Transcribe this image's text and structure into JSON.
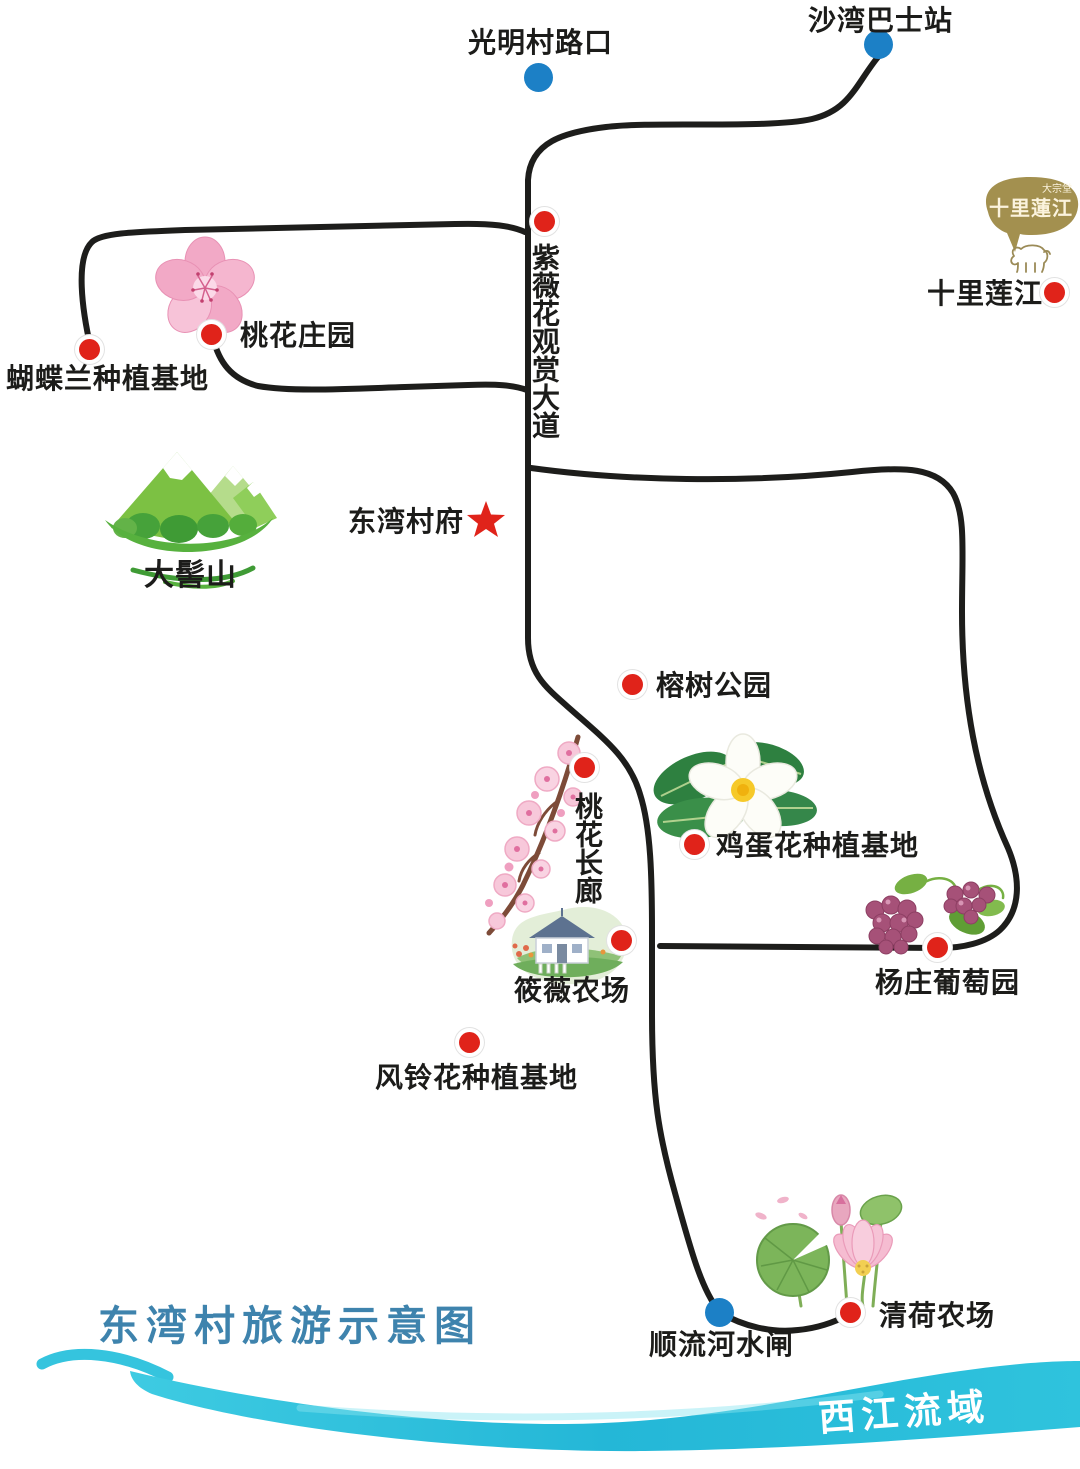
{
  "title": {
    "text": "东湾村旅游示意图"
  },
  "river": {
    "name": "西江流域"
  },
  "logo": {
    "brand": "十里蓮江",
    "sub": "大宗堂"
  },
  "locations": {
    "shawan_bus": {
      "name": "沙湾巴士站",
      "marker": "blue-dot"
    },
    "guangming": {
      "name": "光明村路口",
      "marker": "blue-dot"
    },
    "ziwei_avenue": {
      "name": "紫薇花观赏大道",
      "marker": "red-dot"
    },
    "shili_lianjiang": {
      "name": "十里莲江",
      "marker": "red-dot"
    },
    "hudielan_base": {
      "name": "蝴蝶兰种植基地",
      "marker": "red-dot"
    },
    "taohua_manor": {
      "name": "桃花庄园",
      "marker": "red-dot"
    },
    "daji_mountain": {
      "name": "大髻山",
      "marker": "mountain-icon"
    },
    "dongwan_hall": {
      "name": "东湾村府",
      "marker": "red-star"
    },
    "rongshu_park": {
      "name": "榕树公园",
      "marker": "red-dot"
    },
    "taohua_corridor": {
      "name": "桃花长廊",
      "marker": "red-dot"
    },
    "jidanhua_base": {
      "name": "鸡蛋花种植基地",
      "marker": "red-dot"
    },
    "xiaowei_farm": {
      "name": "筱薇农场",
      "marker": "red-dot"
    },
    "yangzhuang_vineyard": {
      "name": "杨庄葡萄园",
      "marker": "red-dot"
    },
    "fenglinghua_base": {
      "name": "风铃花种植基地",
      "marker": "red-dot"
    },
    "shunliu_sluice": {
      "name": "顺流河水闸",
      "marker": "blue-dot"
    },
    "qinghe_farm": {
      "name": "清荷农场",
      "marker": "red-dot"
    }
  },
  "icons": {
    "bus_stop_marker": "blue-dot",
    "attraction_marker": "red-dot",
    "village_hall_marker": "red-star",
    "daji_mountain": "green-mountain-illustration",
    "peach_blossom": "pink-flower-illustration",
    "peach_branch": "blossom-branch-illustration",
    "frangipani": "white-frangipani-illustration",
    "farmhouse": "farmhouse-illustration",
    "grapes": "grape-cluster-illustration",
    "lotus": "lotus-illustration",
    "cow": "cow-outline-illustration",
    "wave": "river-wave-swoosh"
  },
  "colors": {
    "road": "#1d1d1b",
    "red_marker": "#e0231a",
    "blue_marker": "#1c80c6",
    "title_blue": "#3e83ad",
    "wave_cyan": "#2ec1dc",
    "river_text": "#ffffff",
    "logo_bubble": "#a3904f",
    "star_red": "#e0231a"
  }
}
